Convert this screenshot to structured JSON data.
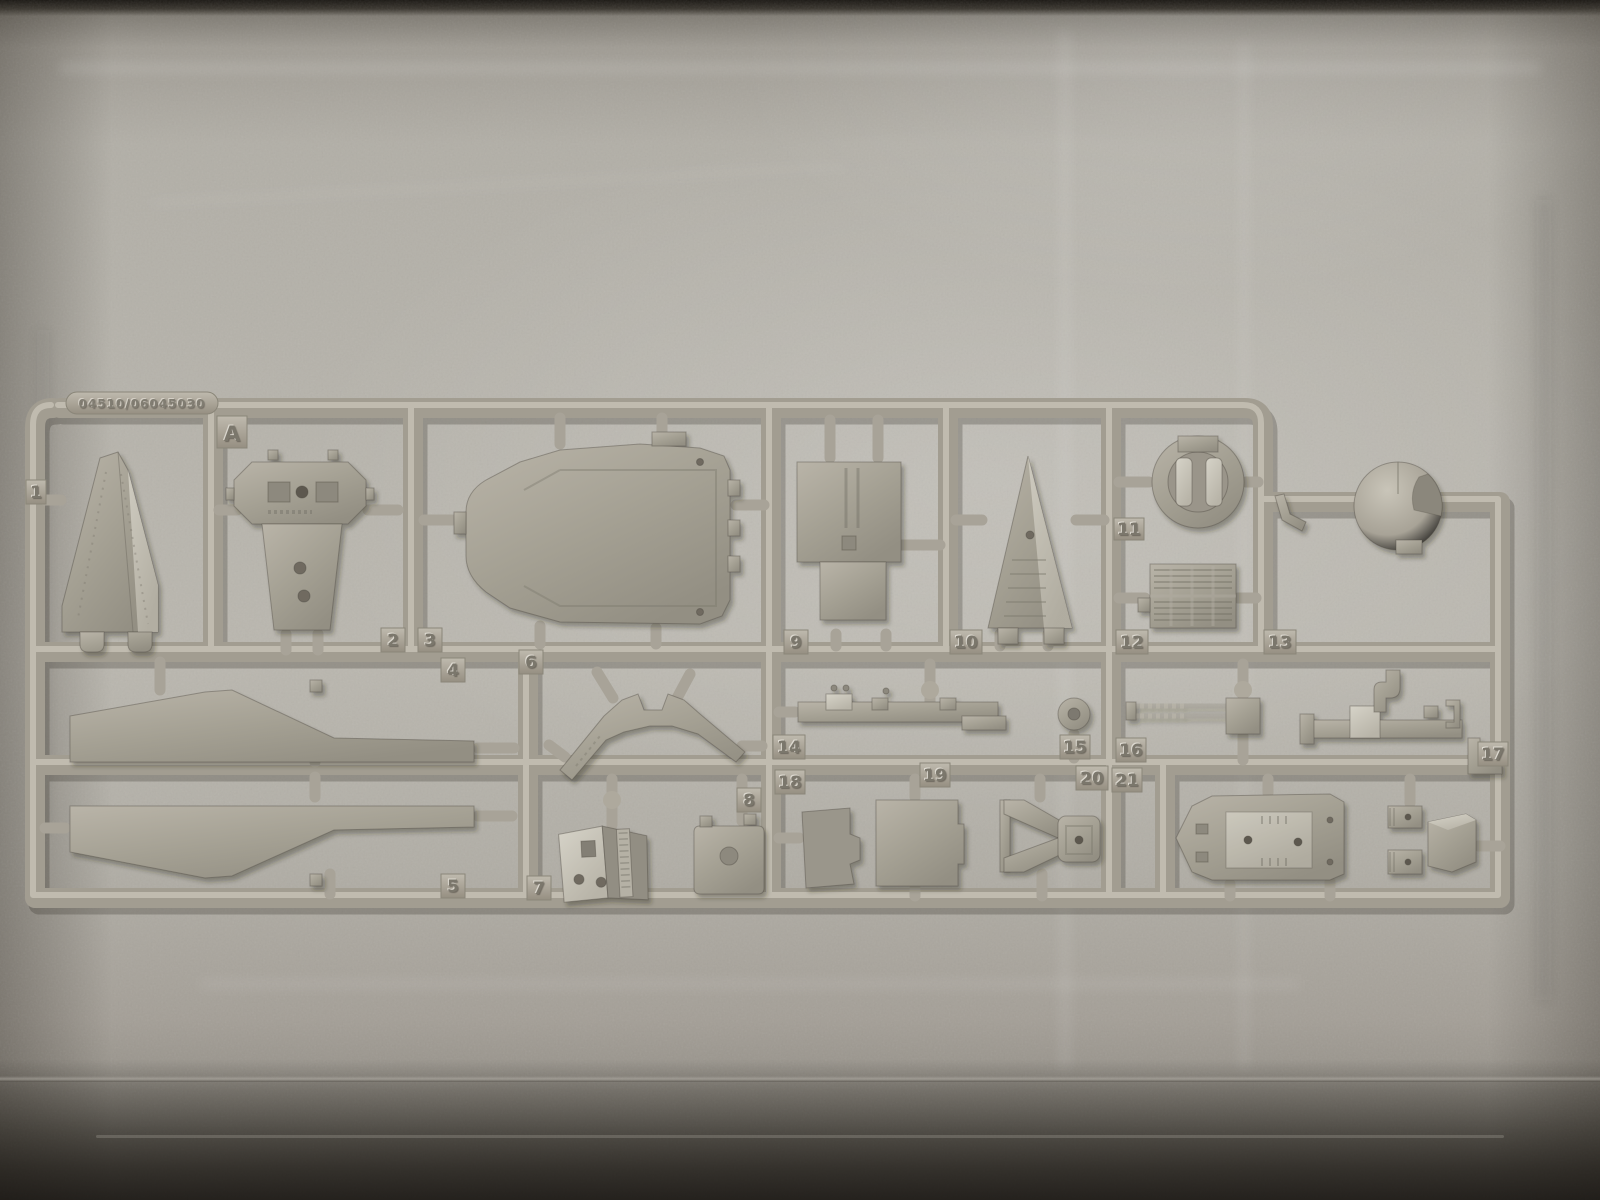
{
  "sprue": {
    "mold_code": "04510/06045030",
    "gate_letter": "A",
    "part_numbers": {
      "n1": "1",
      "n2": "2",
      "n3": "3",
      "n4": "4",
      "n5": "5",
      "n6": "6",
      "n7": "7",
      "n8": "8",
      "n9": "9",
      "n10": "10",
      "n11": "11",
      "n12": "12",
      "n13": "13",
      "n14": "14",
      "n15": "15",
      "n16": "16",
      "n17": "17",
      "n18": "18",
      "n19": "19",
      "n20": "20",
      "n21": "21"
    }
  },
  "colors": {
    "plastic": "#a6a195",
    "plastic_highlight": "#cac6ba",
    "plastic_shadow": "#6f6b61",
    "foam_light": "#bab7af",
    "foam_mid": "#a8a49c",
    "foam_dark": "#8a867e",
    "backdrop_dark": "#2c2822"
  }
}
